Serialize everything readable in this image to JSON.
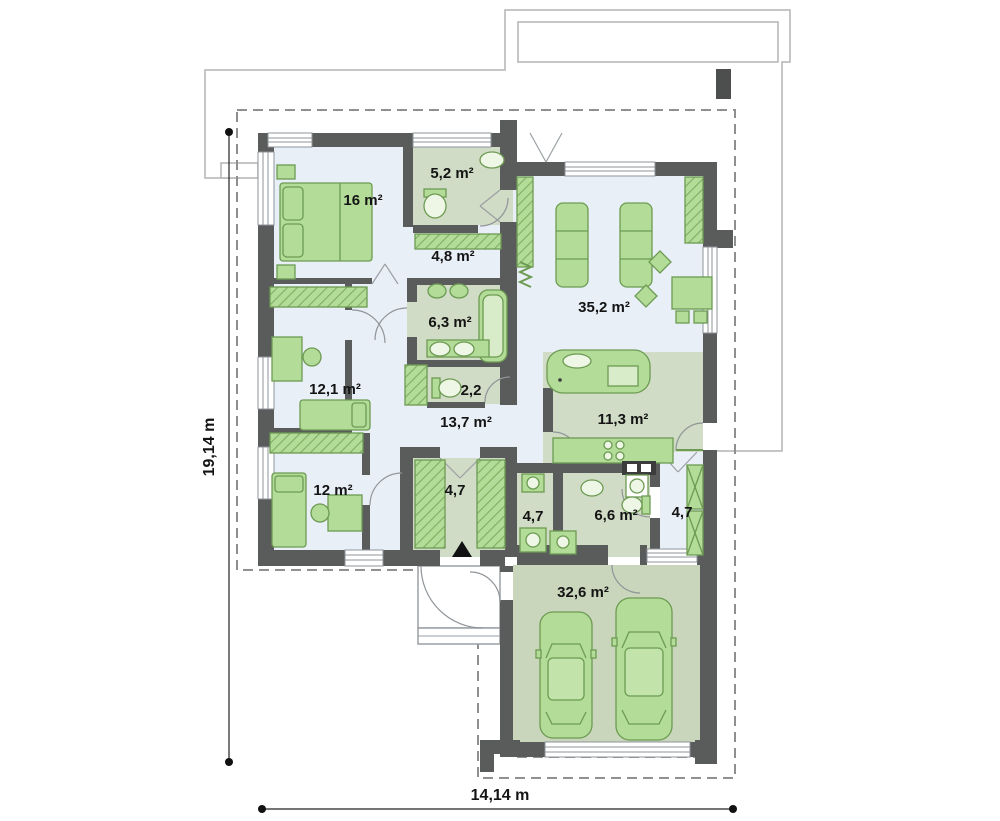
{
  "drawing": {
    "type": "house-floor-plan",
    "dimensions": {
      "width_label": "14,14 m",
      "height_label": "19,14 m"
    },
    "rooms": [
      {
        "name": "bedroom-1",
        "area": "16 m²"
      },
      {
        "name": "bathroom-1",
        "area": "5,2 m²"
      },
      {
        "name": "hall-upper",
        "area": "4,8 m²"
      },
      {
        "name": "bathroom-2",
        "area": "6,3 m²"
      },
      {
        "name": "wc",
        "area": "2,2"
      },
      {
        "name": "bedroom-2",
        "area": "12,1 m²"
      },
      {
        "name": "corridor-main",
        "area": "13,7 m²"
      },
      {
        "name": "living-room",
        "area": "35,2 m²"
      },
      {
        "name": "kitchen",
        "area": "11,3 m²"
      },
      {
        "name": "bedroom-3",
        "area": "12 m²"
      },
      {
        "name": "entrance-hall",
        "area": "4,7"
      },
      {
        "name": "utility-room",
        "area": "4,7"
      },
      {
        "name": "bathroom-3",
        "area": "6,6 m²"
      },
      {
        "name": "corridor-east",
        "area": "4,7"
      },
      {
        "name": "garage",
        "area": "32,6 m²"
      }
    ],
    "colors": {
      "wall": "#5a5b5b",
      "floor_light": "#e9eff7",
      "floor_green": "#d0dcc5",
      "floor_garage": "#c9d6bb",
      "furniture_fill": "#b2dc97",
      "furniture_stroke": "#6d9b53",
      "dashed_boundary": "#8f8f8f",
      "roof_outline": "#b3b3b3",
      "dimension_line": "#222222"
    }
  }
}
